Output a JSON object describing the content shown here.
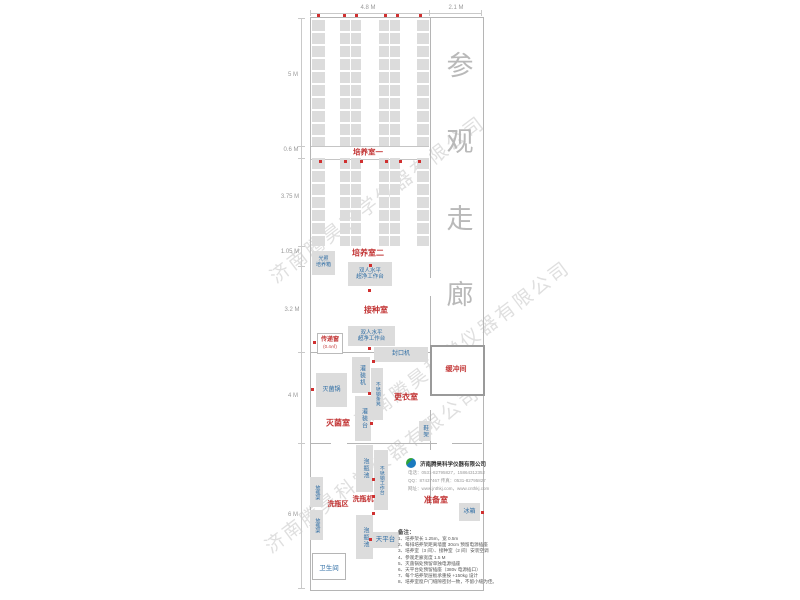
{
  "watermark": {
    "text": "济南腾昊科学仪器有限公司"
  },
  "corridor_chars": [
    "参",
    "观",
    "走",
    "廊"
  ],
  "dimensions": {
    "top": [
      "4.8 M",
      "2.1 M"
    ],
    "left": [
      "5 M",
      "0.6 M",
      "3.75 M",
      "1.05 M",
      "3.2 M",
      "4 M",
      "6 M"
    ]
  },
  "rooms": {
    "culture1": "培养室一",
    "culture2": "培养室二",
    "inoculation": "接种室",
    "sterilization": "灭菌室",
    "changing": "更衣室",
    "buffer": "缓冲间",
    "washing_area": "洗瓶区",
    "prep": "准备室",
    "toilet": "卫生间"
  },
  "equipment": {
    "light_incubator_line1": "光照",
    "light_incubator_line2": "培养箱",
    "clean_bench_line1": "双人水平",
    "clean_bench_line2": "超净工作台",
    "pass_window": "传递窗",
    "pass_window_size": "(0.4㎡)",
    "sealing_machine": "封口机",
    "filling_machine": "灌装机",
    "filling_table": "灌装台",
    "ss_bench": "不锈钢条凳",
    "sterilizer": "灭菌锅",
    "shoe_rack": "鞋架",
    "soak_pool": "泡瓶池",
    "ss_worktable": "不锈钢工作台",
    "bottle_washer": "洗瓶机",
    "bottle_rack": "放瓶架",
    "balance_table": "天平台",
    "fridge": "冰箱"
  },
  "company": {
    "name": "济南腾昊科学仪器有限公司",
    "line1": "电话：0531-82795827，15864312352",
    "line2": "QQ：87437467  传真：0531-82795827",
    "line3": "网址：www.jnthkj.com，www.cnthkj.com"
  },
  "notes": {
    "title": "备注：",
    "items": [
      "1、培养架长 1.25m，宽 0.5m",
      "2、每排培养架距离墙面 30cm 预留电源插座",
      "3、培养室（3 间）、接种室（2 间）安装空调",
      "4、参观走廊宽度 1.5 M",
      "5、灭菌锅处预留单独电源插座",
      "6、天平台处预留插座（380v 电源插口）",
      "7、每个培养架层板承重按 +150kg 设计",
      "8、培养室窗户门缝隙密封一致，不留小缝为佳。"
    ]
  },
  "colors": {
    "room_label": "#c23434",
    "equipment_label": "#2e6da4",
    "box_fill": "#dcdcdc",
    "wall": "#b5b5b5",
    "corridor_text": "#b9b9b9",
    "outlet_dot": "#d03030",
    "logo_blue": "#1a7abf",
    "logo_green": "#2fa23c"
  }
}
